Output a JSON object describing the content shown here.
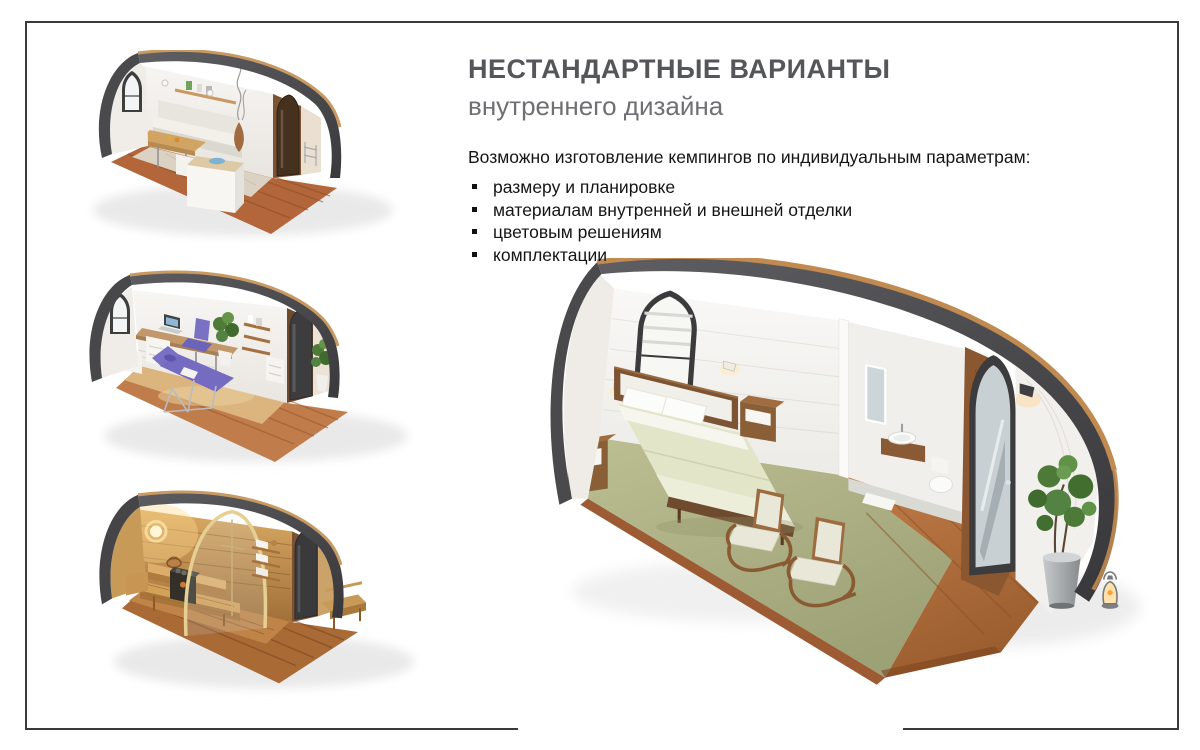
{
  "slide": {
    "title": "НЕСТАНДАРТНЫЕ ВАРИАНТЫ",
    "subtitle": "внутреннего дизайна",
    "intro": "Возможно изготовление кемпингов по индивидуальным параметрам:",
    "bullets": [
      "размеру и планировке",
      "материалам внутренней и внешней отделки",
      "цветовым решениям",
      "комплектации"
    ]
  },
  "figures": {
    "living": "3d-render-pod-living-dining",
    "office": "3d-render-pod-office-massage",
    "sauna": "3d-render-pod-sauna",
    "bedroom": "3d-render-pod-bedroom-with-bathroom"
  },
  "colors": {
    "title": "#55565a",
    "subtitle": "#6f7073",
    "body_text": "#151515",
    "frame_border": "#3a3a3c",
    "pod_shell": "#4a4a4d",
    "roof_edge_wood": "#c89a62",
    "deck_wood": "#b2663a",
    "carpet_green": "#b3b687",
    "accent_purple": "#7a71c5"
  }
}
